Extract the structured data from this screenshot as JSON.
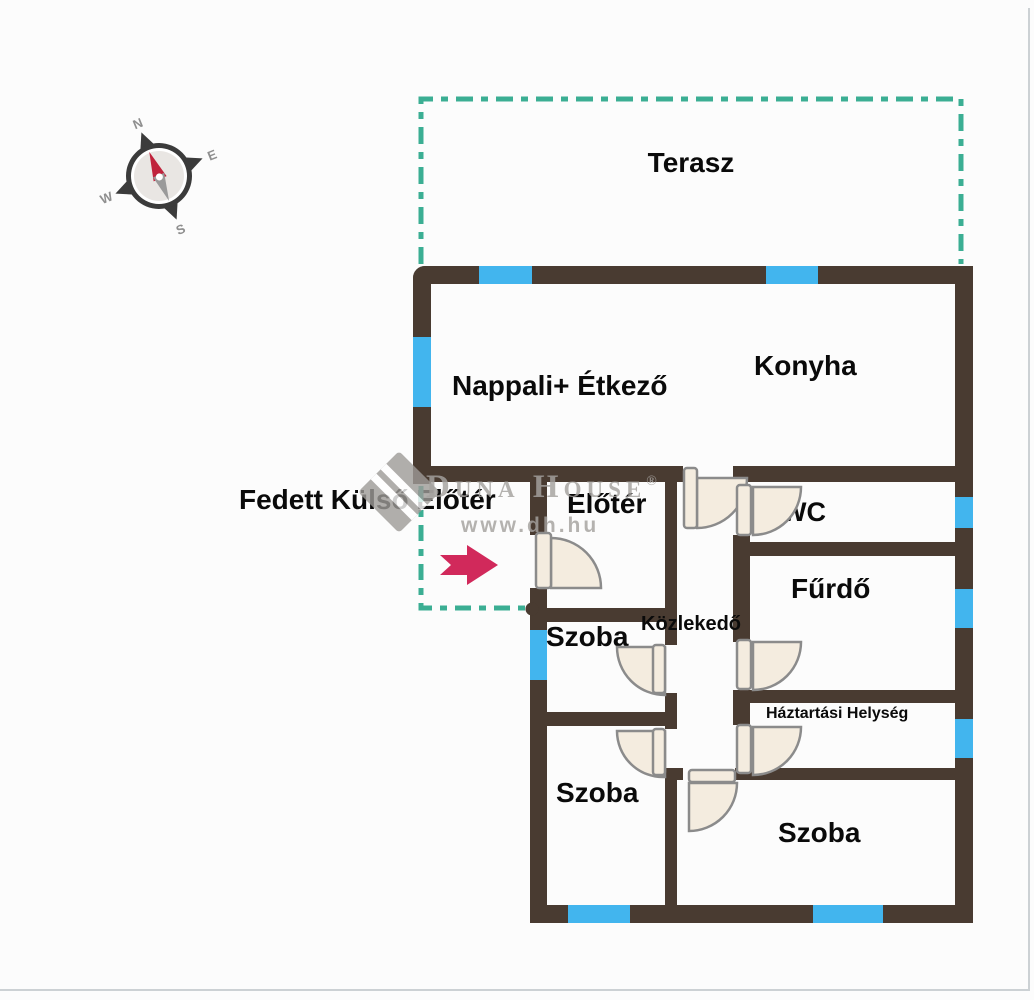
{
  "document": {
    "type": "floor-plan"
  },
  "labels": {
    "terrace": "Terasz",
    "living_dining": "Nappali+ Étkező",
    "kitchen": "Konyha",
    "covered_outdoor_entry": "Fedett Külső Előtér",
    "entry_hall": "Előtér",
    "wc": "WC",
    "bathroom": "Fűrdő",
    "hallway": "Közlekedő",
    "utility_room": "Háztartási Helység",
    "room_1": "Szoba",
    "room_2": "Szoba",
    "room_3": "Szoba"
  },
  "compass": {
    "north": "N",
    "east": "E",
    "south": "S",
    "west": "W"
  },
  "watermark": {
    "brand": "Duna House",
    "registered": "®",
    "url": "www.dh.hu"
  },
  "colors": {
    "background": "#fcfcfc",
    "wall": "#493b31",
    "window": "#42b5ee",
    "terrace_outline": "#3bae93",
    "door_fill": "#f4ecdf",
    "door_stroke": "#8b8b8b",
    "arrow": "#d1295b",
    "label": "#0a0a0a",
    "watermark": "#a5a29f",
    "compass_body": "#3b3b3b",
    "compass_face": "#e9e6e3",
    "compass_needle_red": "#c0233c",
    "compass_needle_gray": "#9a9a9a",
    "compass_letters": "#8f8f8f",
    "frame_line": "#ccd1d4"
  }
}
